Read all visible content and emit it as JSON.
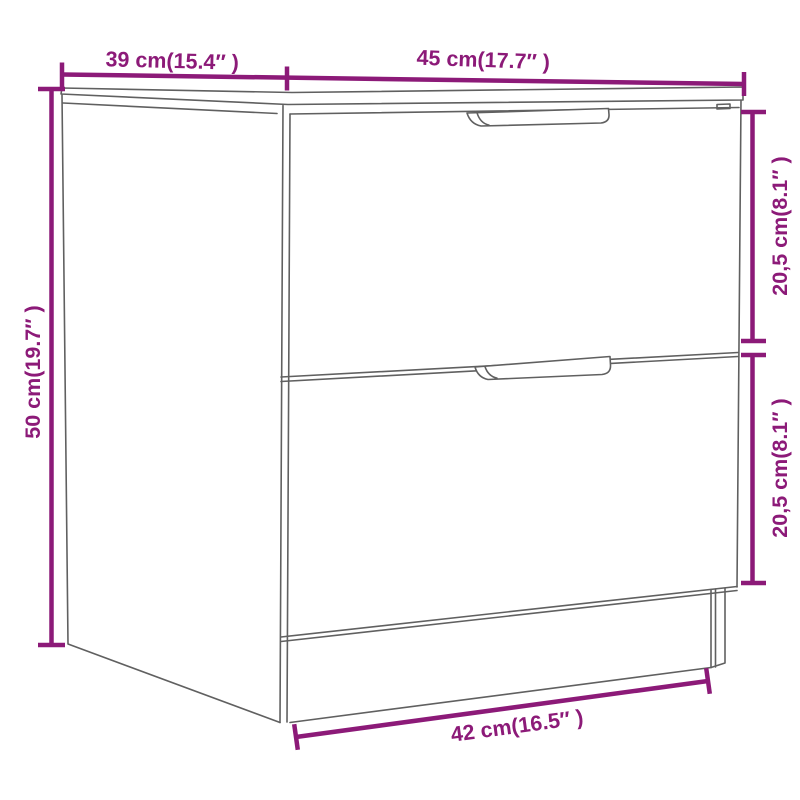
{
  "diagram": {
    "kind": "furniture-dimension-diagram",
    "subject": "nightstand-with-two-drawers",
    "background_color": "#ffffff",
    "line_color": "#606060",
    "dimension_color": "#8C1A78",
    "dimensions": {
      "depth": "39 cm(15.4″ )",
      "width": "45 cm(17.7″ )",
      "height": "50 cm(19.7″ )",
      "upper_drawer_height": "20,5 cm(8.1″ )",
      "lower_drawer_height": "20,5 cm(8.1″ )",
      "base_width": "42 cm(16.5″ )"
    }
  }
}
